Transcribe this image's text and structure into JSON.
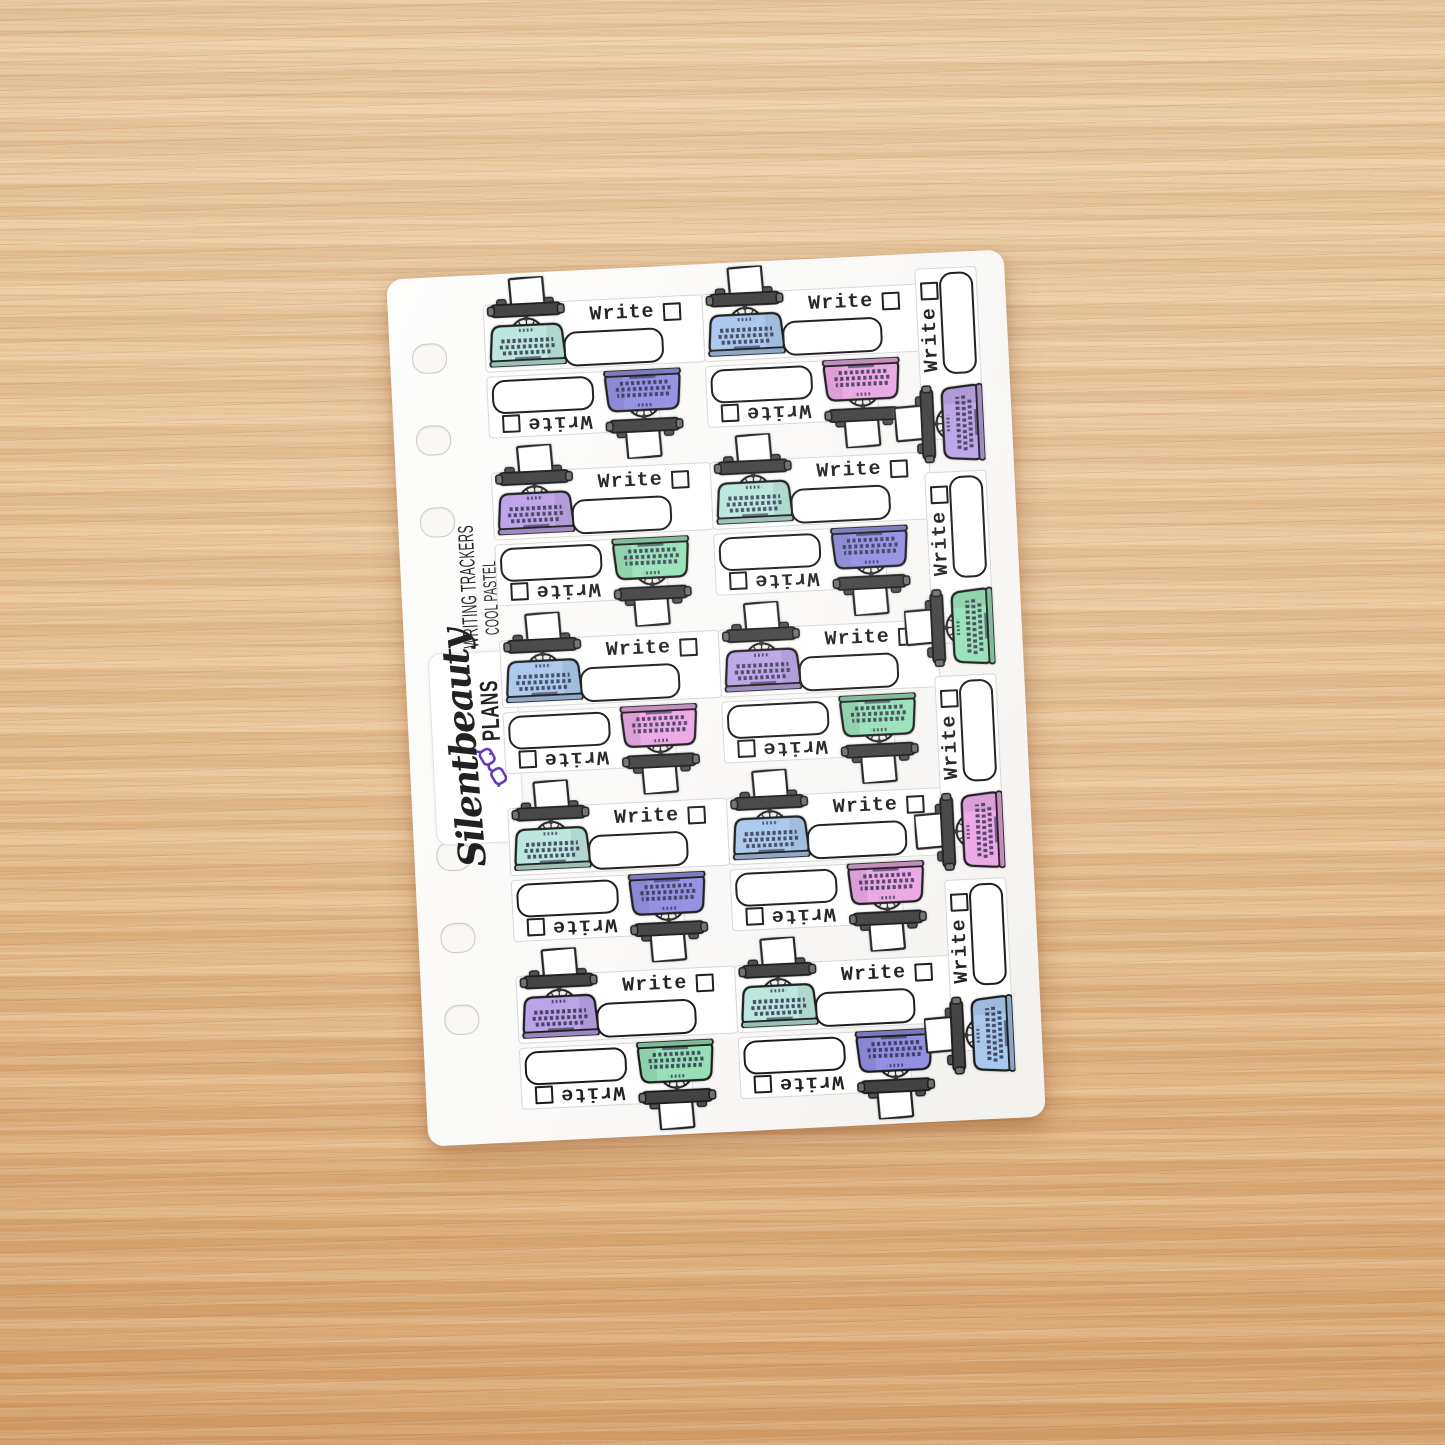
{
  "sheet": {
    "brand_vertical_line1": "WRITING TRACKERS",
    "brand_vertical_line2": "COOL PASTEL"
  },
  "logo": {
    "script_text": "Silentbeauty",
    "caps_text": "PLANS"
  },
  "sticker": {
    "label": "Write"
  },
  "palette": {
    "teal": "#b7e6dc",
    "blue": "#a5c6ec",
    "lavender": "#b9a0e6",
    "periwinkle": "#8f8ce2",
    "pink": "#eaa4e3",
    "green": "#93dfb4"
  },
  "colors": {
    "glasses_purple": "#5a2dbd",
    "ink_black": "#161616",
    "wood_base": "#e7c096",
    "sheet_white": "#fcfcfc"
  },
  "pairs": [
    {
      "upright": "teal",
      "inverted": "periwinkle"
    },
    {
      "upright": "blue",
      "inverted": "pink"
    },
    {
      "upright": "lavender",
      "inverted": "green"
    },
    {
      "upright": "teal",
      "inverted": "periwinkle"
    },
    {
      "upright": "blue",
      "inverted": "pink"
    },
    {
      "upright": "lavender",
      "inverted": "green"
    },
    {
      "upright": "teal",
      "inverted": "periwinkle"
    },
    {
      "upright": "blue",
      "inverted": "pink"
    },
    {
      "upright": "lavender",
      "inverted": "green"
    },
    {
      "upright": "teal",
      "inverted": "periwinkle"
    }
  ],
  "side_stickers": [
    "lavender",
    "green",
    "pink",
    "blue"
  ]
}
